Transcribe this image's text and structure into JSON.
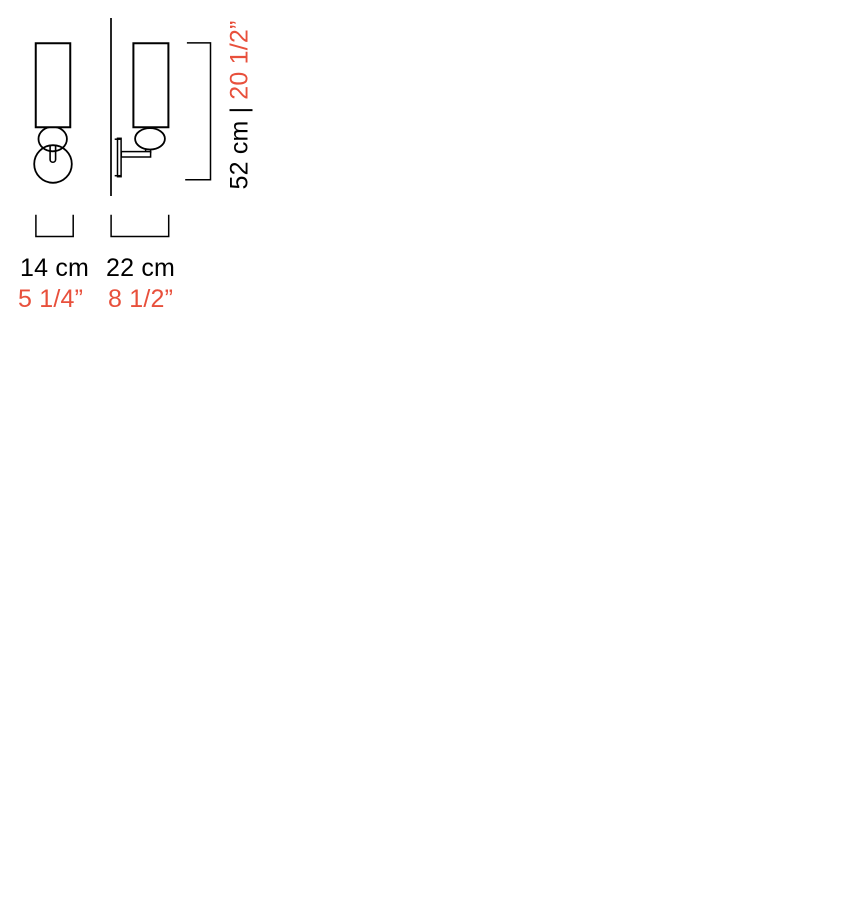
{
  "colors": {
    "background": "#ffffff",
    "line": "#000000",
    "metric_text": "#000000",
    "imperial_text": "#e8503c"
  },
  "dimensions": {
    "height": {
      "metric": "52 cm",
      "separator": "|",
      "imperial": "20 1/2”"
    },
    "front_width": {
      "metric": "14 cm",
      "imperial": "5 1/4”"
    },
    "side_projection": {
      "metric": "22 cm",
      "imperial": "8 1/2”"
    }
  }
}
